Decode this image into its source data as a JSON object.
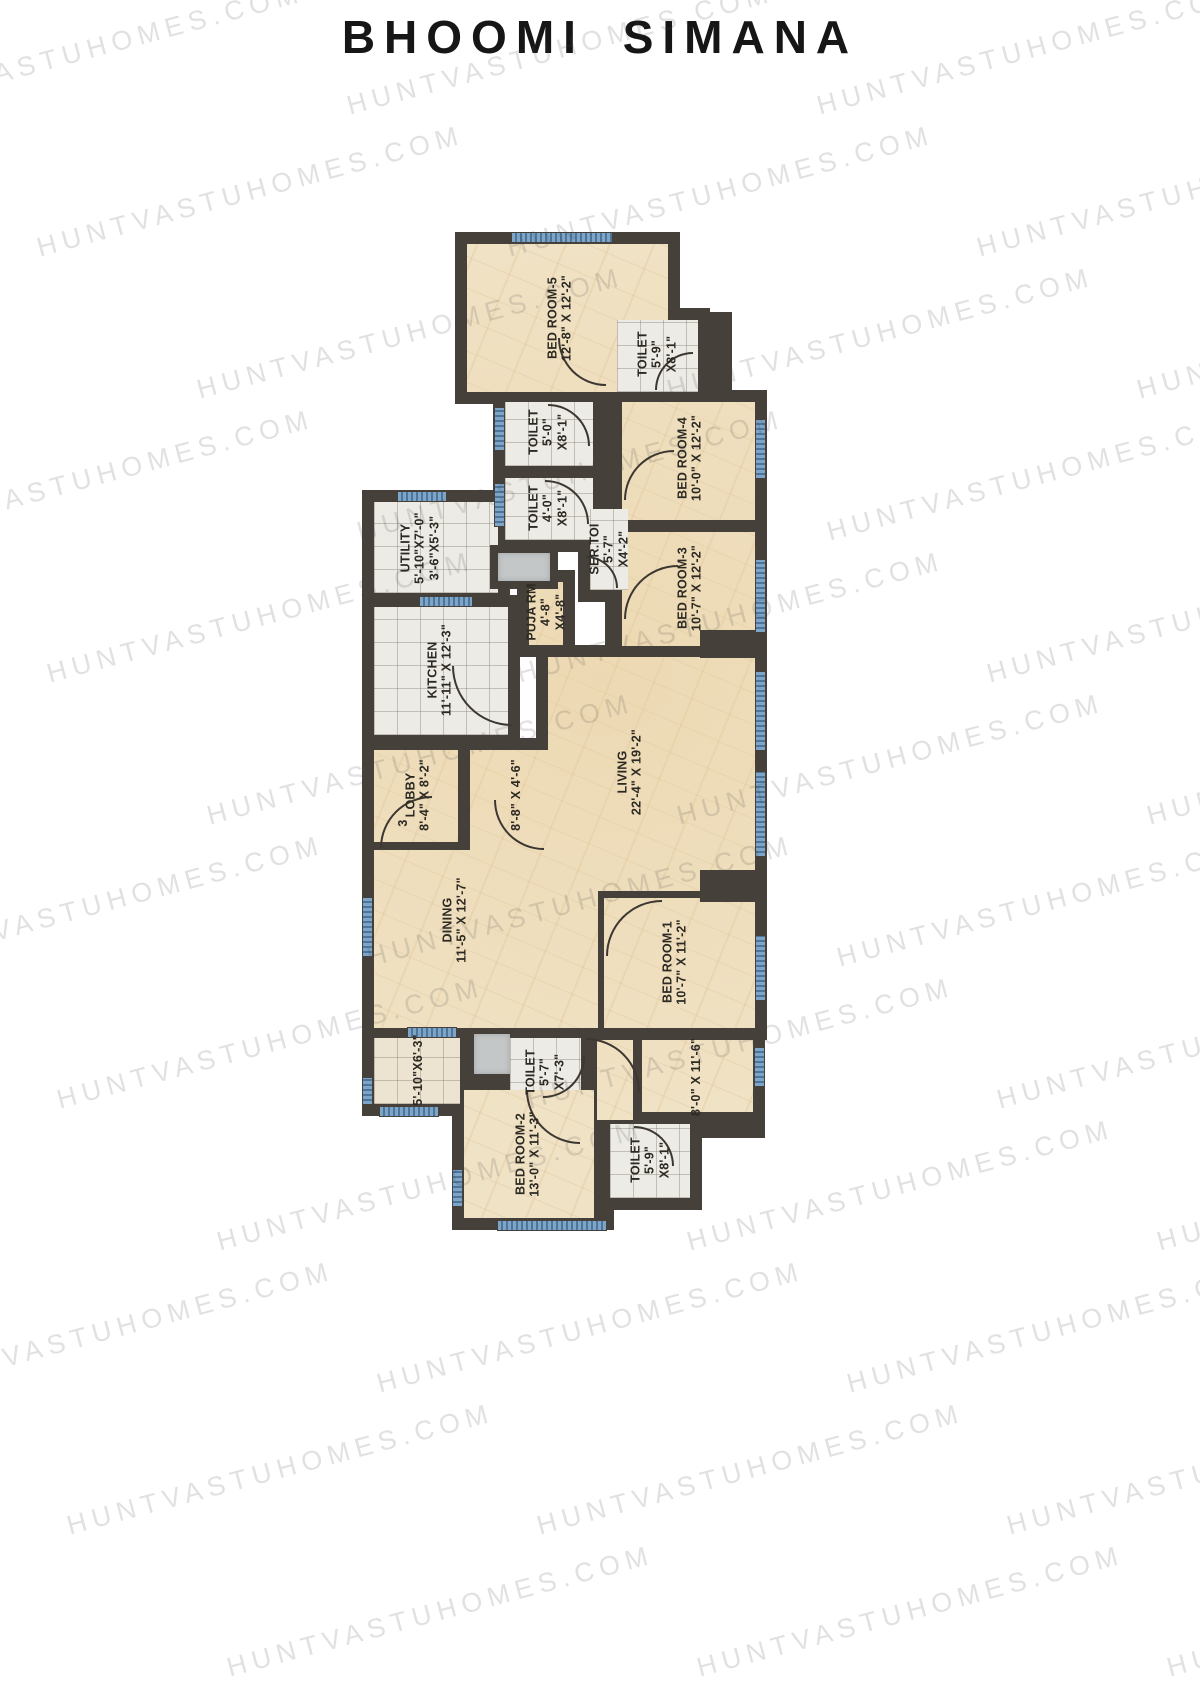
{
  "title": "BHOOMI SIMANA",
  "watermark_text": "HUNTVASTUHOMES.COM",
  "door_label": "3",
  "colors": {
    "wall": "#46403a",
    "marble_floor": "#f0e2c5",
    "tile_floor": "#edebe5",
    "window_blue": "#7da5c8",
    "shaft_gray": "#c4c7c7",
    "label_text": "#2c2923",
    "watermark_gray": "#d6d6d6",
    "title_text": "#161616"
  },
  "rooms": {
    "bedroom5": {
      "name": "BED ROOM-5",
      "dims": "12'-8\" X 12'-2\""
    },
    "toilet1": {
      "name": "TOILET",
      "dims": "5'-9\"",
      "dims2": "X8'-1\""
    },
    "bedroom4": {
      "name": "BED ROOM-4",
      "dims": "10'-0\" X 12'-2\""
    },
    "toilet2": {
      "name": "TOILET",
      "dims": "5'-0\"",
      "dims2": "X8'-1\""
    },
    "toilet3": {
      "name": "TOILET",
      "dims": "4'-0\"",
      "dims2": "X8'-1\""
    },
    "bedroom3": {
      "name": "BED ROOM-3",
      "dims": "10'-7\" X 12'-2\""
    },
    "utility": {
      "name": "UTILITY",
      "dims": "5'-10\"X7'-0\"",
      "dims2": "3'-6\"X5'-3\""
    },
    "ser_toilet": {
      "name": "SER.TOI",
      "dims": "5'-7\"",
      "dims2": "X4'-2\""
    },
    "puja_room": {
      "name": "PUJA RM",
      "dims": "4'-8\"",
      "dims2": "X4'-8\""
    },
    "kitchen": {
      "name": "KITCHEN",
      "dims": "11'-11\" X 12'-3\""
    },
    "lobby": {
      "name": "LOBBY",
      "dims": "8'-4\" X 8'-2\""
    },
    "passage": {
      "dims": "8'-8\" X 4'-6\""
    },
    "living": {
      "name": "LIVING",
      "dims": "22'-4\" X 19'-2\""
    },
    "dining": {
      "name": "DINING",
      "dims": "11'-5\" X 12'-7\""
    },
    "bedroom1": {
      "name": "BED ROOM-1",
      "dims": "10'-7\" X 11'-2\""
    },
    "toilet4": {
      "name": "TOILET",
      "dims": "5'-7\"",
      "dims2": "X7'-3\""
    },
    "dry_area": {
      "dims": "5'-10\"X6'-3\""
    },
    "foyer": {
      "dims": "8'-0\" X 11'-6\""
    },
    "bedroom2": {
      "name": "BED ROOM-2",
      "dims": "13'-0\" X 11'-3\""
    },
    "toilet5": {
      "name": "TOILET",
      "dims": "5'-9\"",
      "dims2": "X8'-1\""
    }
  }
}
